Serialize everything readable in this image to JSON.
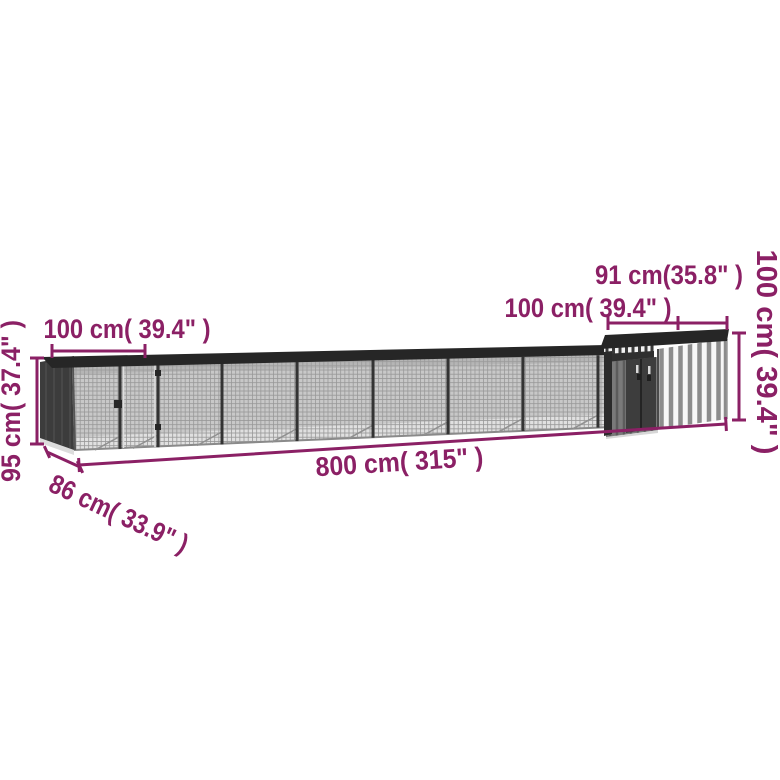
{
  "diagram": {
    "background": "#ffffff",
    "accent_color": "#8b2065",
    "structure_colors": {
      "roof": "#262626",
      "mesh": "#c8c8c8",
      "left_end_wall": "#3c3c3c",
      "shed_stripe_gray": "#8c8c8c",
      "shed_stripe_white": "#f7f7f7",
      "floor": "#e0e0e0"
    },
    "labels": {
      "run_section_width": "100 cm( 39.4\" )",
      "run_height": "95 cm( 37.4\" )",
      "run_depth": "86 cm( 33.9\" )",
      "total_length": "800 cm( 315\" )",
      "shed_width": "91 cm(35.8\" )",
      "shed_depth": "100 cm( 39.4\" )",
      "shed_height": "100 cm( 39.4\" )"
    }
  }
}
